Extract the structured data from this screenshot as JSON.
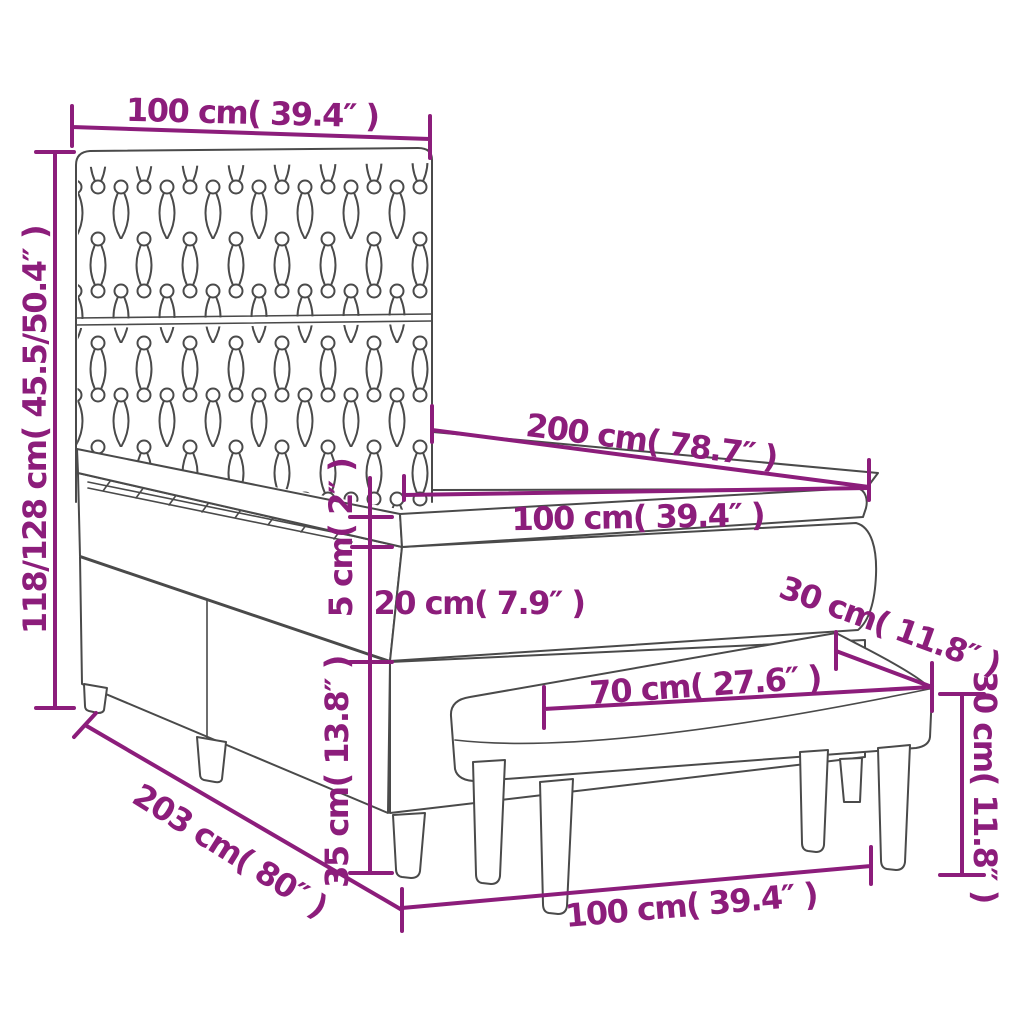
{
  "diagram": {
    "subject": "box spring bed with tufted headboard, mattress topper and bench",
    "colors": {
      "dimension": "#8C1D7B",
      "outline": "#4A4A4A",
      "background": "#FFFFFF"
    },
    "labels": {
      "headboard_width": "100 cm( 39.4″ )",
      "total_height": "118/128 cm( 45.5/50.4″ )",
      "bed_length": "200 cm( 78.7″ )",
      "bed_width": "100 cm( 39.4″ )",
      "topper_thickness": "5 cm( 2″ )",
      "mattress_thickness": "20 cm( 7.9″ )",
      "bench_depth": "30 cm( 11.8″ )",
      "bench_seat_length": "70 cm( 27.6″ )",
      "bench_height": "30 cm( 11.8″ )",
      "base_height": "35 cm( 13.8″ )",
      "total_length": "203 cm( 80″ )",
      "bench_length": "100 cm( 39.4″ )"
    }
  }
}
